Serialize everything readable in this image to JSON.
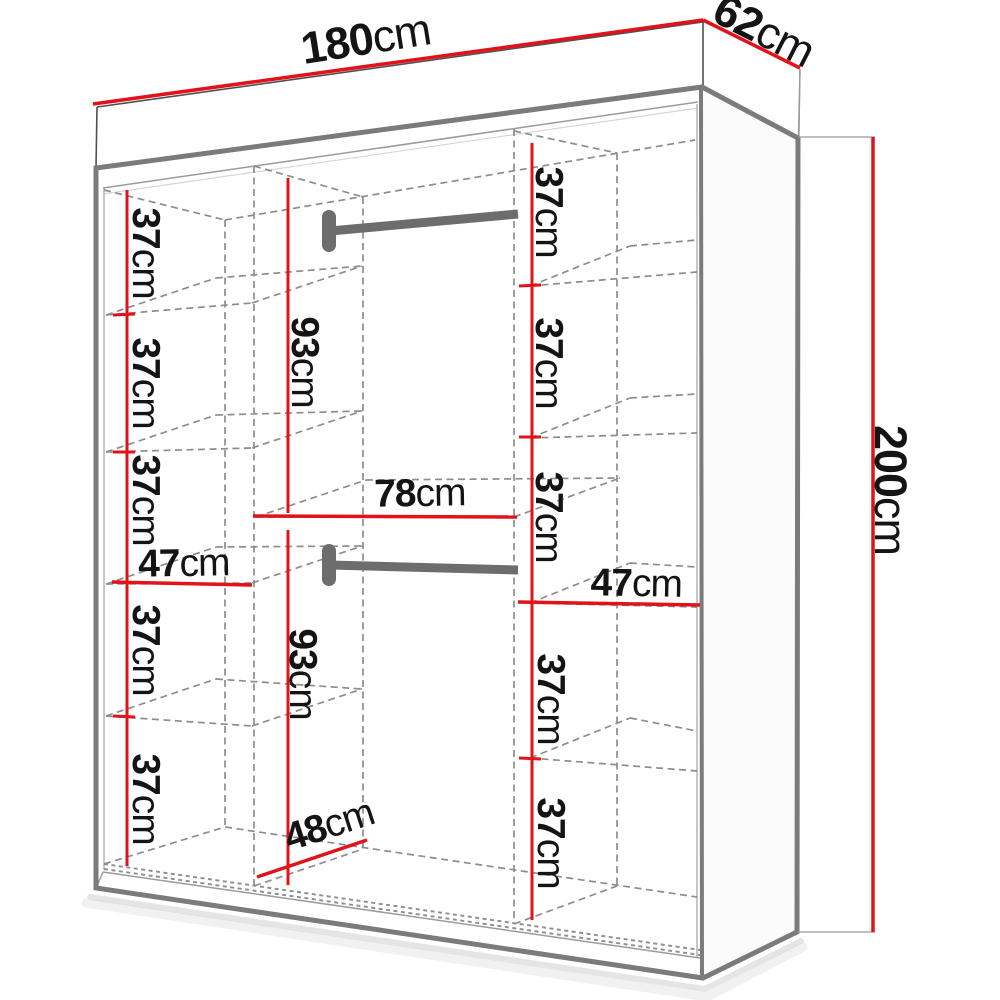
{
  "colors": {
    "dimension_red": "#e2121a",
    "outline_gray": "#7b7b7b",
    "hidden_gray": "#8d8d8d",
    "rod_gray": "#6d6d6d",
    "ink": "#141414",
    "background": "#ffffff"
  },
  "labels": {
    "width": {
      "value": "180",
      "unit": "cm"
    },
    "depth": {
      "value": "62",
      "unit": "cm"
    },
    "height": {
      "value": "200",
      "unit": "cm"
    },
    "left_shelf_heights": [
      {
        "value": "37",
        "unit": "cm"
      },
      {
        "value": "37",
        "unit": "cm"
      },
      {
        "value": "37",
        "unit": "cm"
      },
      {
        "value": "37",
        "unit": "cm"
      },
      {
        "value": "37",
        "unit": "cm"
      }
    ],
    "left_compartment_width": {
      "value": "47",
      "unit": "cm"
    },
    "right_shelf_heights": [
      {
        "value": "37",
        "unit": "cm"
      },
      {
        "value": "37",
        "unit": "cm"
      },
      {
        "value": "37",
        "unit": "cm"
      },
      {
        "value": "37",
        "unit": "cm"
      },
      {
        "value": "37",
        "unit": "cm"
      }
    ],
    "right_compartment_width": {
      "value": "47",
      "unit": "cm"
    },
    "upper_hanging_height": {
      "value": "93",
      "unit": "cm"
    },
    "lower_hanging_height": {
      "value": "93",
      "unit": "cm"
    },
    "middle_section_width": {
      "value": "78",
      "unit": "cm"
    },
    "interior_depth": {
      "value": "48",
      "unit": "cm"
    }
  }
}
